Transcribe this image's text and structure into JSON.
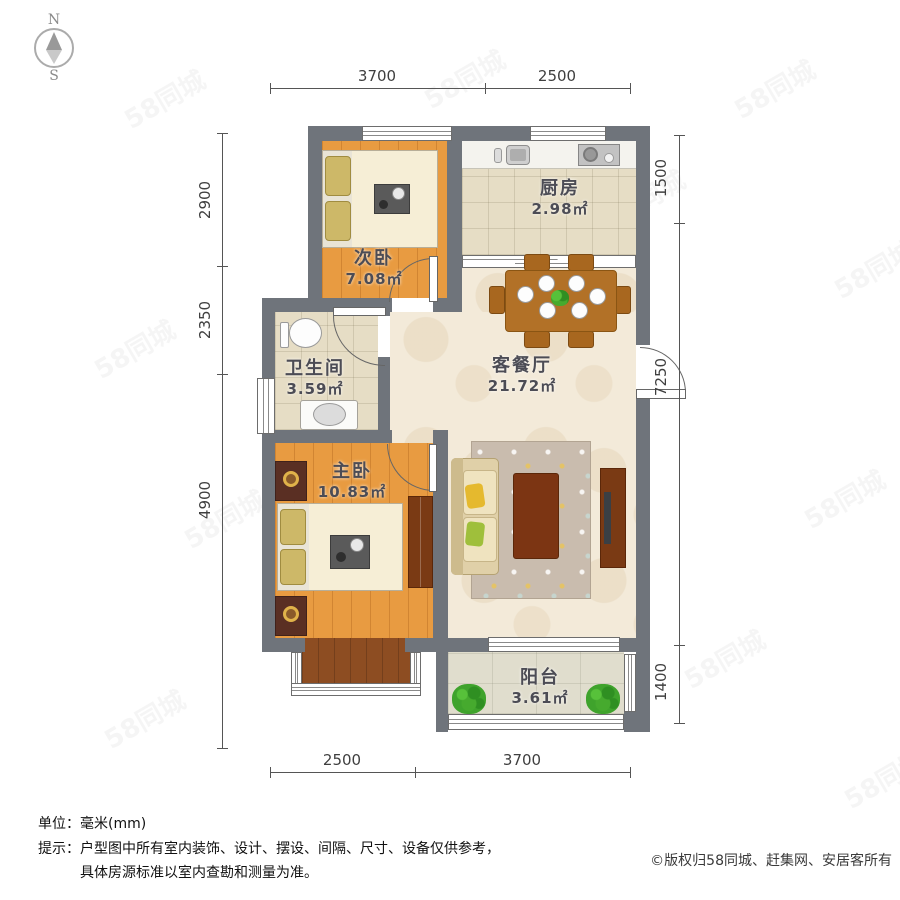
{
  "compass": {
    "north_label": "N",
    "south_label": "S"
  },
  "dimensions": {
    "top": [
      {
        "label": "3700"
      },
      {
        "label": "2500"
      }
    ],
    "bottom": [
      {
        "label": "2500"
      },
      {
        "label": "3700"
      }
    ],
    "left": [
      {
        "label": "2900"
      },
      {
        "label": "2350"
      },
      {
        "label": "4900"
      }
    ],
    "right": [
      {
        "label": "1500"
      },
      {
        "label": "7250"
      },
      {
        "label": "1400"
      }
    ]
  },
  "rooms": [
    {
      "name": "次卧",
      "area": "7.08㎡"
    },
    {
      "name": "厨房",
      "area": "2.98㎡"
    },
    {
      "name": "卫生间",
      "area": "3.59㎡"
    },
    {
      "name": "客餐厅",
      "area": "21.72㎡"
    },
    {
      "name": "主卧",
      "area": "10.83㎡"
    },
    {
      "name": "阳台",
      "area": "3.61㎡"
    }
  ],
  "footer": {
    "unit_label": "单位：",
    "unit_value": "毫米(mm)",
    "tip_label": "提示：",
    "tip_line1": "户型图中所有室内装饰、设计、摆设、间隔、尺寸、设备仅供参考，",
    "tip_line2": "具体房源标准以室内查勘和测量为准。",
    "copyright": "©版权归58同城、赶集网、安居客所有"
  },
  "watermark": {
    "text": "58同城"
  },
  "colors": {
    "wall": "#6f747b",
    "wood_floor": "#e89b41",
    "tile_floor": "#e6ddc5",
    "living_floor": "#f3ead9",
    "balcony_floor": "#e0ddcd",
    "bay_floor": "#8d4d22",
    "table_wood": "#b27127",
    "dark_wood": "#7a3a14",
    "sofa": "#e0d0a8",
    "rug": "#c9bcae",
    "plant": "#3fa32c",
    "label_text": "#4c4c55",
    "dim_text": "#3f3f3f",
    "footer_text": "#111111",
    "watermark": "#888888"
  }
}
